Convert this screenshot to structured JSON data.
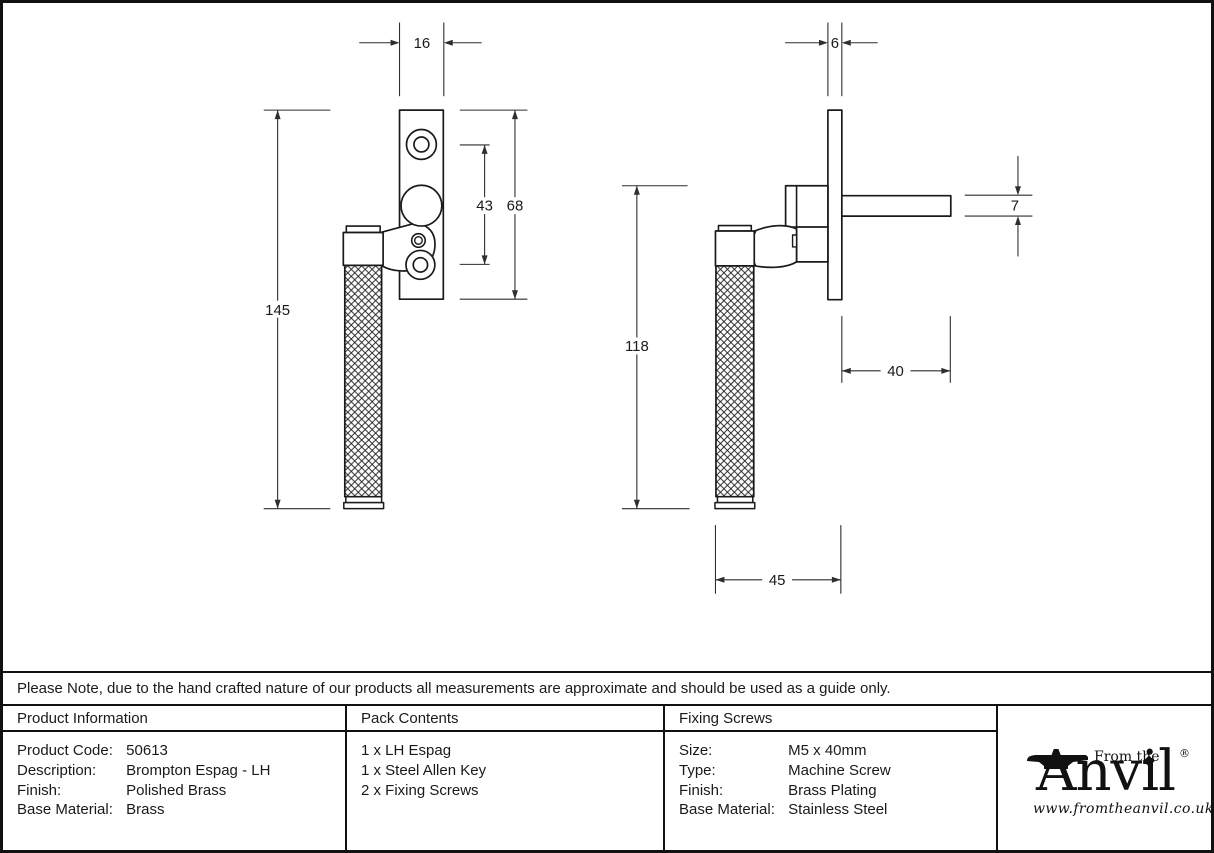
{
  "note": {
    "text": "Please Note, due to the hand crafted nature of our products all measurements are approximate and should be used as a guide only."
  },
  "drawing": {
    "front_view": {
      "plate_width_mm": "16",
      "screw_spacing_mm": "43",
      "plate_height_mm": "68",
      "overall_length_mm": "145"
    },
    "side_view": {
      "plate_thickness_mm": "6",
      "handle_length_mm": "118",
      "spindle_length_mm": "40",
      "spindle_square_mm": "7",
      "projection_mm": "45"
    }
  },
  "table": {
    "product_information": {
      "title": "Product Information",
      "rows": [
        {
          "label": "Product Code:",
          "value": "50613"
        },
        {
          "label": "Description:",
          "value": "Brompton Espag - LH"
        },
        {
          "label": "Finish:",
          "value": "Polished Brass"
        },
        {
          "label": "Base Material:",
          "value": "Brass"
        }
      ]
    },
    "pack_contents": {
      "title": "Pack Contents",
      "items": [
        "1 x LH Espag",
        "1 x Steel Allen Key",
        "2 x Fixing Screws"
      ]
    },
    "fixing_screws": {
      "title": "Fixing Screws",
      "rows": [
        {
          "label": "Size:",
          "value": "M5 x 40mm"
        },
        {
          "label": "Type:",
          "value": "Machine Screw"
        },
        {
          "label": "Finish:",
          "value": "Brass Plating"
        },
        {
          "label": "Base Material:",
          "value": "Stainless Steel"
        }
      ]
    }
  },
  "logo": {
    "tagline": "From the",
    "name_initial": "A",
    "name_rest": "nvil",
    "registered": "®",
    "url": "www.fromtheanvil.co.uk"
  },
  "colors": {
    "line": "#1a1a1a",
    "dim": "#2e2e2e",
    "background": "#ffffff"
  }
}
